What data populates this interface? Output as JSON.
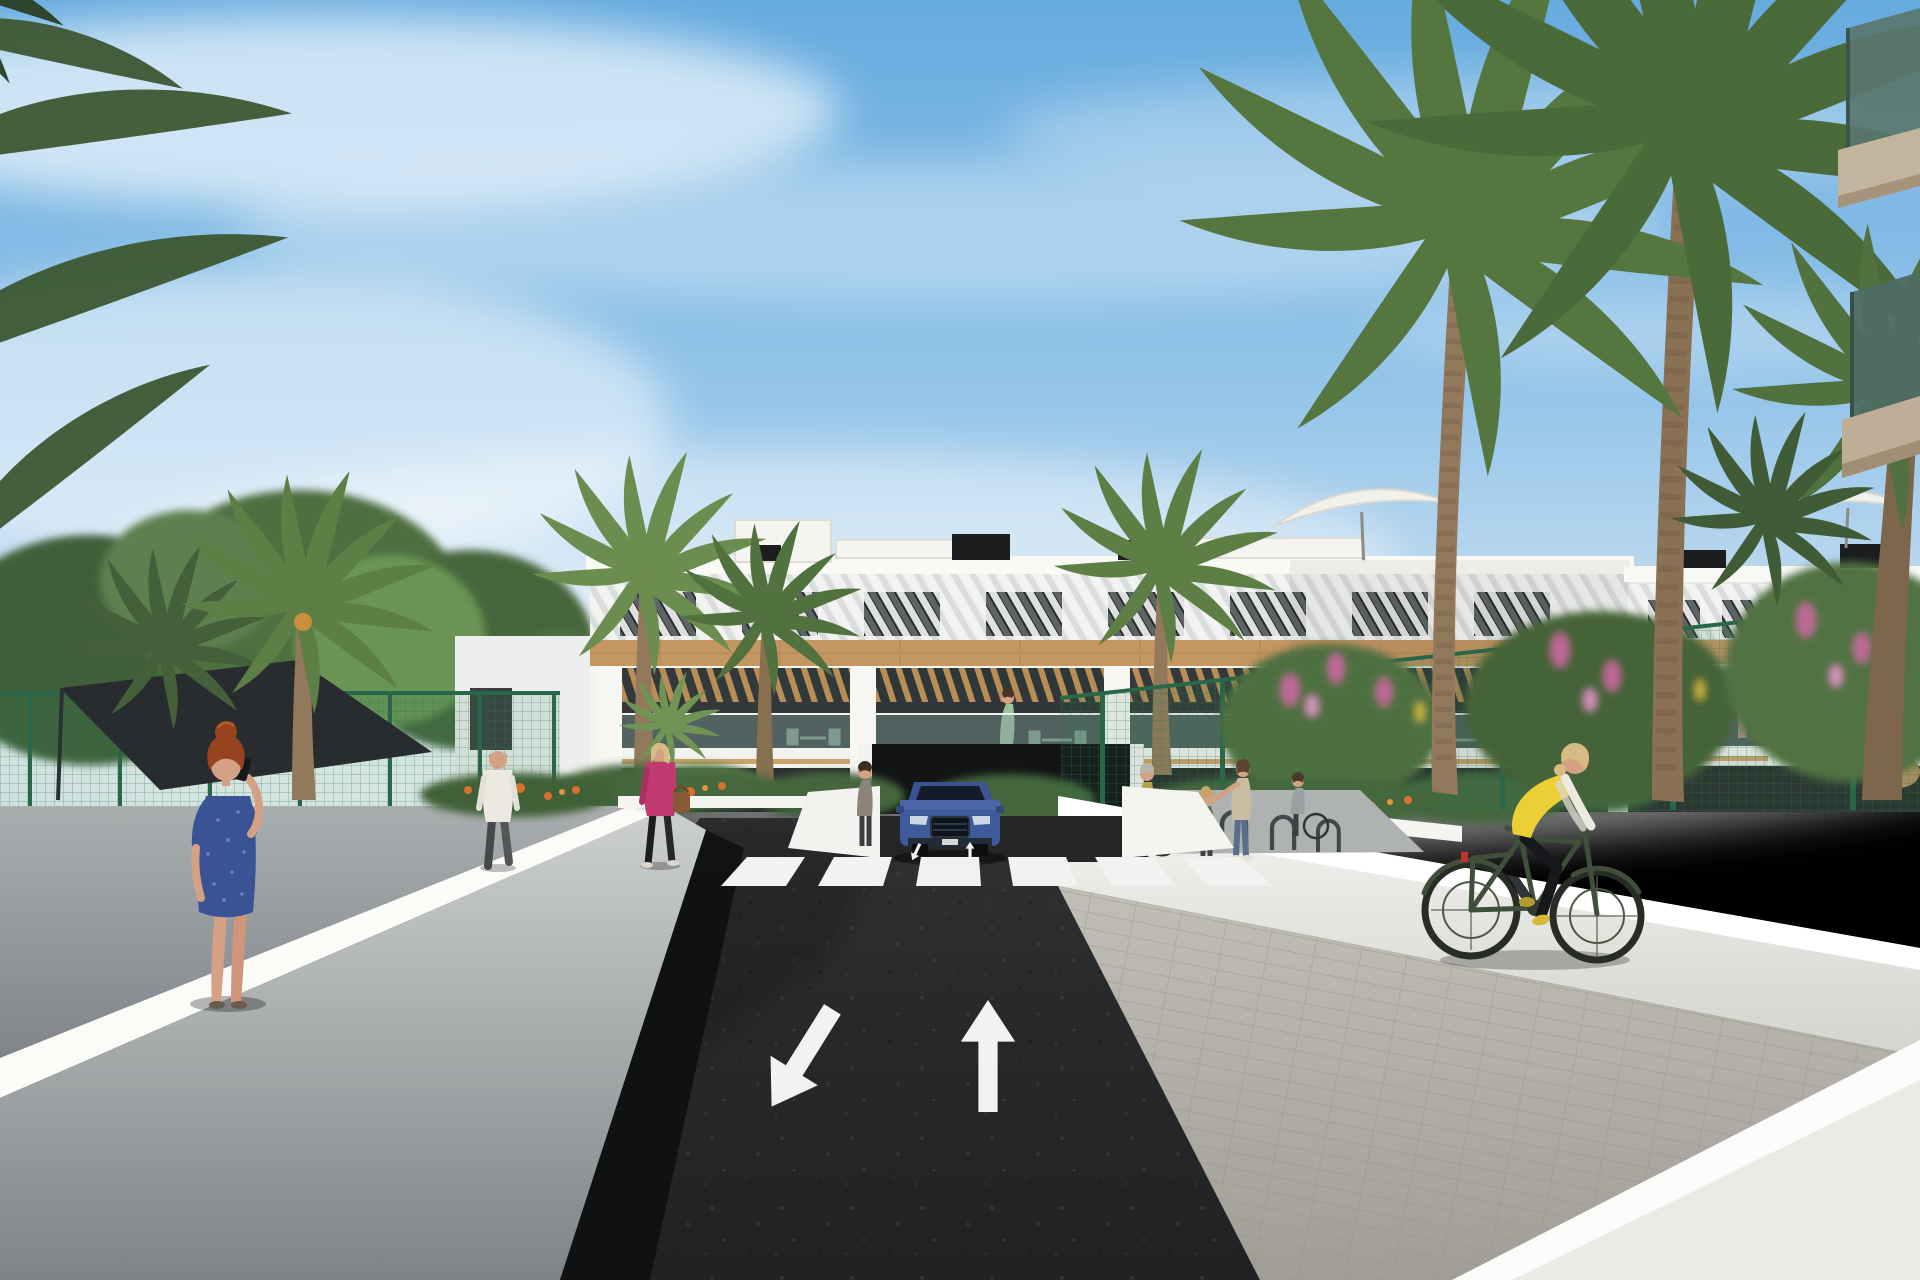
{
  "meta": {
    "image_type": "3d-architectural-rendering",
    "setting": "street view of a modern white apartment complex with palm trees, crosswalk and cyclist path"
  },
  "scene": {
    "sky": {
      "description": "blue sky with wispy white cirrus clouds"
    },
    "building": {
      "storeys": 3,
      "style": "white modern facade, diagonal white louvres on top floor, horizontal wood band, timber pergolas over balconies, glass balustrades",
      "roof_features": [
        "black vent boxes",
        "white parasols",
        "roof terraces"
      ]
    },
    "road": {
      "surface": "dark asphalt",
      "crosswalk_stripes": 6,
      "lane_arrows": [
        "toward-viewer (down-left)",
        "away-from-viewer (up)"
      ],
      "small_ramp_arrows": 2
    },
    "vehicle": {
      "type": "SUV",
      "color": "dark blue",
      "state": "exiting underground garage ramp"
    },
    "people": [
      {
        "id": "phone-woman",
        "desc": "red-haired woman in blue patterned dress on phone, seen from behind, left path"
      },
      {
        "id": "man-white-tshirt",
        "desc": "man in white t-shirt and dark trousers walking on left path"
      },
      {
        "id": "woman-pink-jacket",
        "desc": "blonde woman in magenta jacket, black trousers, brown handbag"
      },
      {
        "id": "family-group",
        "desc": "woman with bicycle, child with hat, woman in floral top, woman in grey top near bike racks"
      },
      {
        "id": "cyclist",
        "desc": "blonde woman, yellow vest over white sleeves, black leggings, dark green bicycle on right paver path"
      },
      {
        "id": "garage-person",
        "desc": "small figure standing beside garage entrance"
      }
    ],
    "vegetation": {
      "palms": "tall date palms flanking the street, two large palms right foreground, fronds entering top-left",
      "shrubs": [
        "pink flowering shrubs along right fence",
        "orange flowers in planter beds",
        "green hedges at building base"
      ],
      "other": [
        "dark shade sail behind left green mesh fence"
      ]
    },
    "foreground": {
      "top_right": "two glass balconies with beige slabs of a nearer building"
    }
  },
  "palette": {
    "facade": "#f4f4f1",
    "facadeShade": "#e7e7e2",
    "windowDark": "#272b2c",
    "wood": "#c39662",
    "pergola": "#b98d55",
    "glassBalcony": "#7e9a97",
    "asphalt": "#282a2c",
    "marking": "#f2f3f0",
    "sidewalk": "#9aa0a2",
    "pavers": "#b7b4ab",
    "wallWhite": "#f7f7f4",
    "fenceGreen": "#2e7d52",
    "foliageDark": "#3c5c36",
    "foliageMid": "#517243",
    "foliageLight": "#6b9153",
    "palmGreen": "#5d7f46",
    "palmDark": "#43603a",
    "trunk": "#93795c",
    "flowerPink": "#c06898",
    "flowerOrange": "#d96f2e",
    "suvBlue": "#3d5a9a",
    "sail": "#282c2e",
    "skin": "#d5a184",
    "dressBlue": "#3a5394",
    "jacketMagenta": "#c23a72",
    "vestYellow": "#eccf35",
    "bikeGreen": "#3f4f3a",
    "hairAuburn": "#97431f",
    "hairBlonde": "#d6bc82",
    "parasol": "#f1f1ec",
    "vent": "#1b1d1e"
  }
}
